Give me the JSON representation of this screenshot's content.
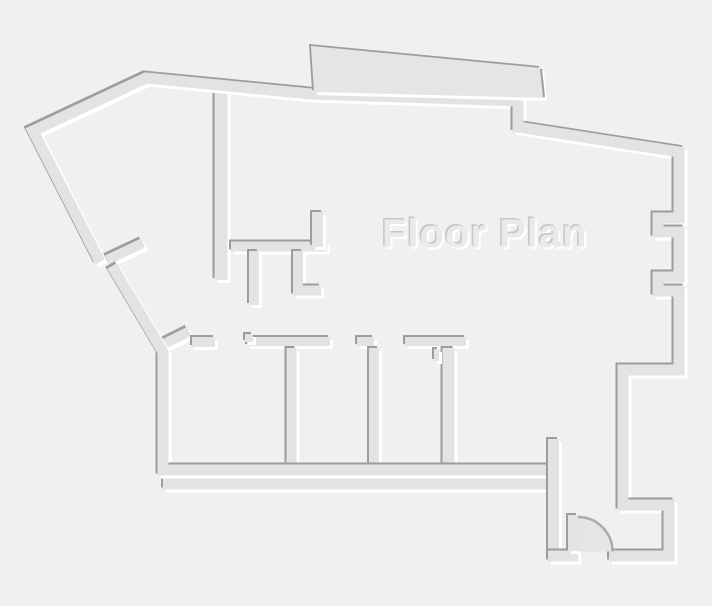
{
  "title": {
    "text": "Floor Plan"
  },
  "canvas": {
    "width": 712,
    "height": 606,
    "background": "#f0f0f1"
  },
  "style": {
    "wall_color": "#e2e3e5",
    "slab_color": "#e4e5e6",
    "shadow_color": "#9c9da0",
    "highlight_color": "#ffffff",
    "text_color": "#e9eaeb",
    "text_shadow_dark": "#c4c6c7",
    "text_shadow_light": "#ffffff",
    "door_arc_color": "#a8aaac"
  },
  "floor_plan": {
    "walls": [
      {
        "name": "interior-room-divider",
        "w": 13,
        "points": [
          [
            221,
            92
          ],
          [
            221,
            280
          ]
        ]
      },
      {
        "name": "interior-closet-top",
        "w": 10,
        "points": [
          [
            231,
            246.5
          ],
          [
            327,
            246.5
          ]
        ]
      },
      {
        "name": "interior-closet-stub",
        "w": 11,
        "points": [
          [
            317.5,
            212
          ],
          [
            317.5,
            247
          ]
        ]
      },
      {
        "name": "interior-stub-left",
        "w": 10,
        "points": [
          [
            254,
            251
          ],
          [
            254,
            305
          ]
        ]
      },
      {
        "name": "interior-stub-l-shape",
        "w": 10,
        "points": [
          [
            298,
            251
          ],
          [
            298,
            290.5
          ],
          [
            321,
            290.5
          ]
        ]
      },
      {
        "name": "door-leaf-upper",
        "w": 10,
        "points": [
          [
            107,
            260
          ],
          [
            143,
            243
          ]
        ]
      },
      {
        "name": "door-leaf-lower",
        "w": 10,
        "points": [
          [
            159,
            346.5
          ],
          [
            189,
            331.5
          ]
        ]
      },
      {
        "name": "rooms-top-segment-1",
        "w": 10,
        "points": [
          [
            192,
            342
          ],
          [
            215,
            342
          ]
        ]
      },
      {
        "name": "rooms-top-segment-2",
        "w": 9,
        "points": [
          [
            247,
            341.5
          ],
          [
            330,
            341.5
          ]
        ]
      },
      {
        "name": "rooms-top-segment-2-notch",
        "w": 8,
        "points": [
          [
            249,
            334
          ],
          [
            249,
            342
          ]
        ]
      },
      {
        "name": "rooms-top-segment-3",
        "w": 9,
        "points": [
          [
            357,
            341.5
          ],
          [
            374,
            341.5
          ]
        ]
      },
      {
        "name": "rooms-top-segment-4",
        "w": 9,
        "points": [
          [
            405,
            341.5
          ],
          [
            466,
            341.5
          ]
        ]
      },
      {
        "name": "partition-1",
        "w": 10,
        "points": [
          [
            291.5,
            348
          ],
          [
            291.5,
            466
          ]
        ]
      },
      {
        "name": "partition-2",
        "w": 10,
        "points": [
          [
            374,
            348
          ],
          [
            374,
            466
          ]
        ]
      },
      {
        "name": "partition-3",
        "w": 12,
        "points": [
          [
            448.5,
            348
          ],
          [
            448.5,
            466
          ]
        ]
      },
      {
        "name": "partition-3-notch",
        "w": 5,
        "points": [
          [
            436.5,
            349
          ],
          [
            436.5,
            361
          ]
        ]
      },
      {
        "name": "outer-bottom-lower",
        "w": 11,
        "points": [
          [
            163,
            484
          ],
          [
            553,
            484
          ]
        ]
      },
      {
        "name": "left-lower-and-rooms-bottom",
        "w": 11,
        "points": [
          [
            112,
            266
          ],
          [
            163,
            352
          ],
          [
            163,
            470
          ],
          [
            553,
            470
          ]
        ]
      },
      {
        "name": "entry-room-left",
        "w": 11,
        "points": [
          [
            553.5,
            439
          ],
          [
            553.5,
            556
          ]
        ]
      },
      {
        "name": "entry-bottom-left",
        "w": 11,
        "points": [
          [
            548,
            556
          ],
          [
            578,
            556
          ]
        ]
      },
      {
        "name": "entry-door-jamb",
        "w": 10,
        "points": [
          [
            573,
            515
          ],
          [
            573,
            551
          ]
        ]
      },
      {
        "name": "outer-main",
        "w": 11,
        "points": [
          [
            100,
            262
          ],
          [
            33,
            131
          ],
          [
            146,
            78
          ],
          [
            311,
            94
          ],
          [
            518,
            101
          ],
          [
            518,
            127
          ],
          [
            679,
            152
          ],
          [
            679,
            218
          ],
          [
            658,
            218
          ],
          [
            658,
            232
          ],
          [
            679,
            232
          ],
          [
            679,
            277
          ],
          [
            658,
            277
          ],
          [
            658,
            291
          ],
          [
            679,
            291
          ],
          [
            679,
            370
          ],
          [
            623,
            370
          ],
          [
            623,
            505
          ],
          [
            669,
            505
          ],
          [
            669,
            556
          ],
          [
            609,
            556
          ]
        ]
      }
    ],
    "slab": {
      "points": [
        [
          311,
          46
        ],
        [
          541,
          68
        ],
        [
          544,
          98
        ],
        [
          314,
          92
        ]
      ]
    },
    "slab_edge": {
      "points": [
        [
          541,
          69
        ],
        [
          544,
          97
        ]
      ]
    },
    "door_swing": {
      "cx": 578,
      "cy": 551.5,
      "r": 34.5
    }
  }
}
